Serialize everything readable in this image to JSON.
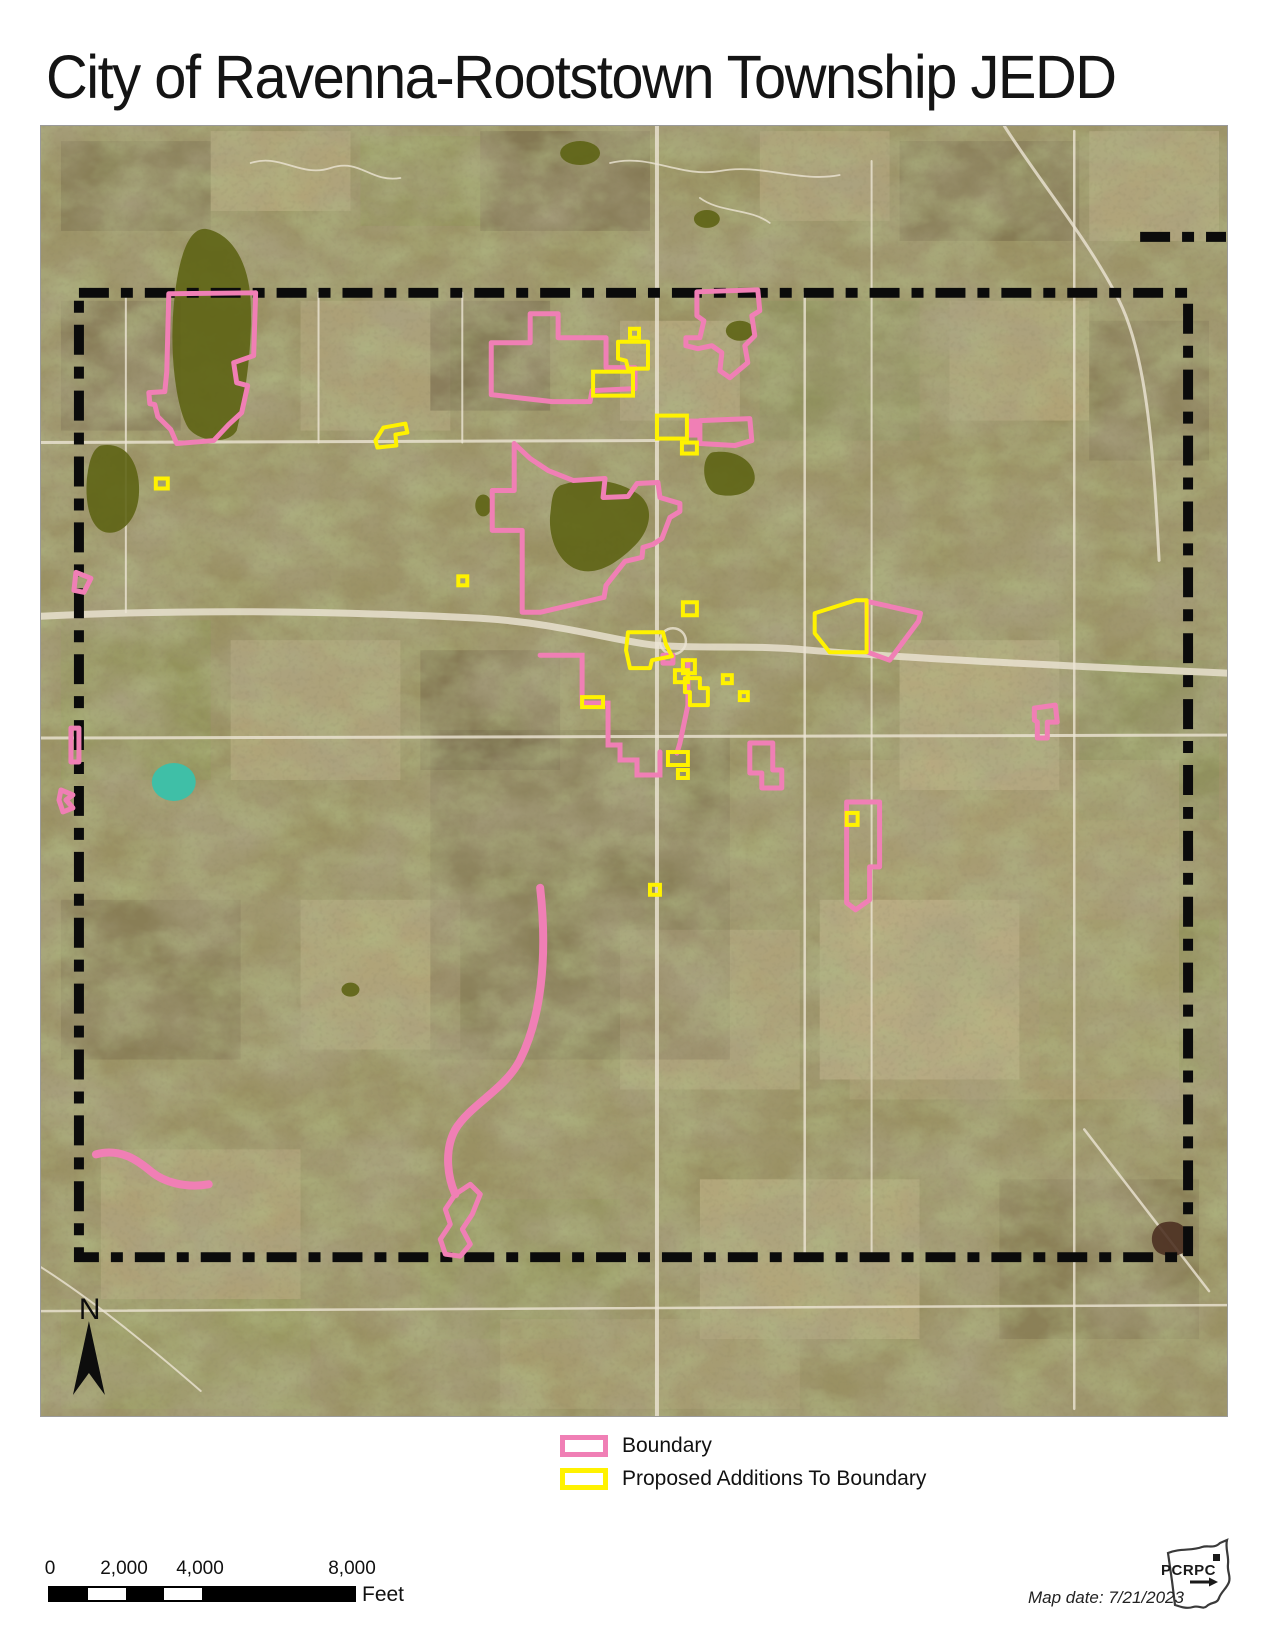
{
  "title": "City of Ravenna-Rootstown Township JEDD",
  "north_label": "N",
  "legend": {
    "items": [
      {
        "label": "Boundary",
        "color": "#f07fb5"
      },
      {
        "label": "Proposed Additions To Boundary",
        "color": "#fff200"
      }
    ]
  },
  "scale_bar": {
    "labels": [
      "0",
      "2,000",
      "4,000",
      "8,000"
    ],
    "unit": "Feet"
  },
  "map_date": "Map date: 7/21/2023",
  "logo": {
    "text": "PCRPC"
  },
  "colors": {
    "boundary_pink": "#f07fb5",
    "proposed_yellow": "#fff200",
    "township_dash": "#0b0b0b",
    "road": "#ece5d4",
    "lake": "#5c6212",
    "pond_teal": "#3fbfa7"
  },
  "map": {
    "road_color": "#ece5d4",
    "lake_color": "#5c6212",
    "boundary": {
      "d": "M78,292 H1189 V1258 H78 Z",
      "extra": "M1141,236 L1227,236",
      "color": "#0b0b0b",
      "dash": "30 12 12 12",
      "width": 10
    },
    "pink": {
      "color": "#f07fb5",
      "width": 5,
      "polygons": [
        "168,293 255,292 253,355 233,362 236,382 247,385 241,412 228,424 213,440 176,443 170,429 157,416 154,404 149,403 148,392 164,391 166,371",
        "491,342 530,342 530,313 558,313 558,337 606,337 606,367 635,367 635,388 592,390 590,401 552,401 491,394",
        "697,291 758,289 760,310 752,315 755,335 745,345 748,362 730,377 720,370 722,352 712,345 698,348 686,345 686,337 700,337 704,320 697,315",
        "514,443 530,458 548,470 573,480 605,478 603,497 628,496 637,483 658,482 660,497 680,503 680,511 670,517 662,538 653,544 643,547 642,557 625,561 606,585 604,597 540,612 522,612 522,530 492,530 492,490 514,490",
        "867,601 921,613 919,621 890,660 868,652",
        "750,743 773,743 773,770 782,770 782,788 762,788 762,773 750,773",
        "847,802 880,802 880,867 870,867 870,900 856,910 847,903",
        "1035,708 1056,705 1058,722 1048,722 1048,738 1038,738 1038,722 1035,720",
        "700,420 750,418 752,440 735,445 700,443",
        "75,572 90,578 83,592 73,590",
        "70,728 78,728 78,762 70,762",
        "60,790 72,795 65,800 72,808 62,812 58,800",
        "455,1195 470,1185 480,1195 472,1215 462,1230 470,1245 460,1257 445,1255 440,1240 450,1225 445,1210",
        "663,655 673,655 673,663 663,663"
      ],
      "paths": [
        {
          "d": "M540,655 L582,655 L582,703 L608,703 L608,745 L620,745 L620,760 L637,760 L637,775 L660,775 L660,752",
          "w": 5
        },
        {
          "d": "M688,660 L688,705 L680,743 L677,753",
          "w": 5
        },
        {
          "d": "M540,888 C548,960 540,1020 520,1060 C505,1090 470,1105 455,1130 C443,1152 448,1180 455,1195",
          "w": 8
        },
        {
          "d": "M95,1155 C120,1148 138,1162 150,1172 C163,1183 185,1189 208,1185",
          "w": 8
        }
      ],
      "filled": [
        {
          "x": 688,
          "y": 418,
          "w": 12,
          "h": 19
        }
      ]
    },
    "yellow": {
      "color": "#fff200",
      "width": 4,
      "polygons": [
        "375,440 383,427 405,423 407,432 395,434 396,445 377,447",
        "618,341 648,341 648,368 628,368 626,360 618,358",
        "815,613 856,600 867,600 867,652 830,652 815,633",
        "628,632 663,632 666,644 672,656 652,660 650,668 630,668 626,650",
        "685,678 700,678 700,688 708,688 708,705 690,705 690,692 685,692"
      ],
      "rects": [
        [
          155,
          478,
          12,
          10
        ],
        [
          593,
          371,
          40,
          24
        ],
        [
          630,
          328,
          9,
          9
        ],
        [
          657,
          415,
          30,
          23
        ],
        [
          682,
          442,
          15,
          11
        ],
        [
          683,
          602,
          14,
          13
        ],
        [
          675,
          670,
          13,
          12
        ],
        [
          683,
          660,
          12,
          13
        ],
        [
          723,
          675,
          9,
          8
        ],
        [
          740,
          692,
          8,
          8
        ],
        [
          582,
          697,
          21,
          10
        ],
        [
          847,
          813,
          11,
          12
        ],
        [
          650,
          885,
          10,
          10
        ],
        [
          668,
          752,
          20,
          13
        ],
        [
          678,
          770,
          10,
          8
        ],
        [
          458,
          576,
          9,
          9
        ]
      ]
    },
    "roads": [
      {
        "d": "M40,616 C200,608 360,612 480,618 C560,623 610,640 655,645 C700,649 745,644 810,650 C920,659 1090,667 1228,673",
        "w": 7
      },
      {
        "circle": [
          673,
          641,
          13
        ],
        "w": 2.5
      },
      {
        "d": "M657,125 L657,1417",
        "w": 4
      },
      {
        "d": "M40,442 L658,440",
        "w": 3
      },
      {
        "d": "M40,738 L1228,735",
        "w": 3
      },
      {
        "d": "M40,1312 L1228,1306",
        "w": 2.5
      },
      {
        "d": "M805,292 L805,1260",
        "w": 2.5
      },
      {
        "d": "M872,160 L872,1258",
        "w": 2
      },
      {
        "d": "M1075,130 L1075,1410",
        "w": 2.5
      },
      {
        "d": "M318,292 L318,442",
        "w": 2
      },
      {
        "d": "M125,292 L125,612",
        "w": 2
      },
      {
        "d": "M462,292 L462,442",
        "w": 2
      },
      {
        "d": "M1005,125 C1040,180 1090,240 1120,300 C1150,360 1155,470 1160,560",
        "w": 3
      },
      {
        "d": "M1085,1130 L1210,1292",
        "w": 2.5
      },
      {
        "d": "M40,1268 C90,1300 140,1340 200,1392",
        "w": 2
      },
      {
        "d": "M250,162 C280,152 300,177 330,167 C360,157 370,182 400,177",
        "w": 1.8
      },
      {
        "d": "M610,162 C650,152 680,177 720,170 C760,162 800,182 840,174",
        "w": 1.8
      },
      {
        "d": "M700,197 C720,212 750,207 770,222",
        "w": 1.8
      }
    ],
    "lakes": [
      {
        "d": "M205,228 C230,232 248,260 250,300 C252,340 246,390 236,430 C228,444 200,442 188,428 C176,410 170,360 172,320 C174,280 182,226 205,228"
      },
      {
        "d": "M100,445 C130,440 140,470 138,495 C136,520 120,535 105,532 C88,528 84,500 86,478 C88,460 92,448 100,445"
      },
      {
        "d": "M560,485 C590,475 620,480 640,495 C655,508 650,530 635,545 C620,560 600,575 580,570 C560,565 548,540 550,515 C552,498 552,490 560,485"
      },
      {
        "d": "M712,452 C735,448 755,460 755,478 C754,492 735,498 718,494 C702,490 700,458 712,452"
      },
      {
        "e": [
          740,
          330,
          14,
          10
        ]
      },
      {
        "e": [
          173,
          782,
          22,
          19
        ],
        "fill": "#3fbfa7",
        "op": 1
      },
      {
        "e": [
          483,
          505,
          8,
          11
        ]
      },
      {
        "e": [
          580,
          152,
          20,
          12
        ]
      },
      {
        "e": [
          707,
          218,
          13,
          9
        ]
      },
      {
        "e": [
          350,
          990,
          9,
          7
        ]
      },
      {
        "d": "M1162,1224 C1180,1218 1192,1230 1190,1245 C1188,1256 1172,1260 1160,1254 C1150,1248 1150,1230 1162,1224",
        "fill": "#4a2e20"
      }
    ]
  }
}
